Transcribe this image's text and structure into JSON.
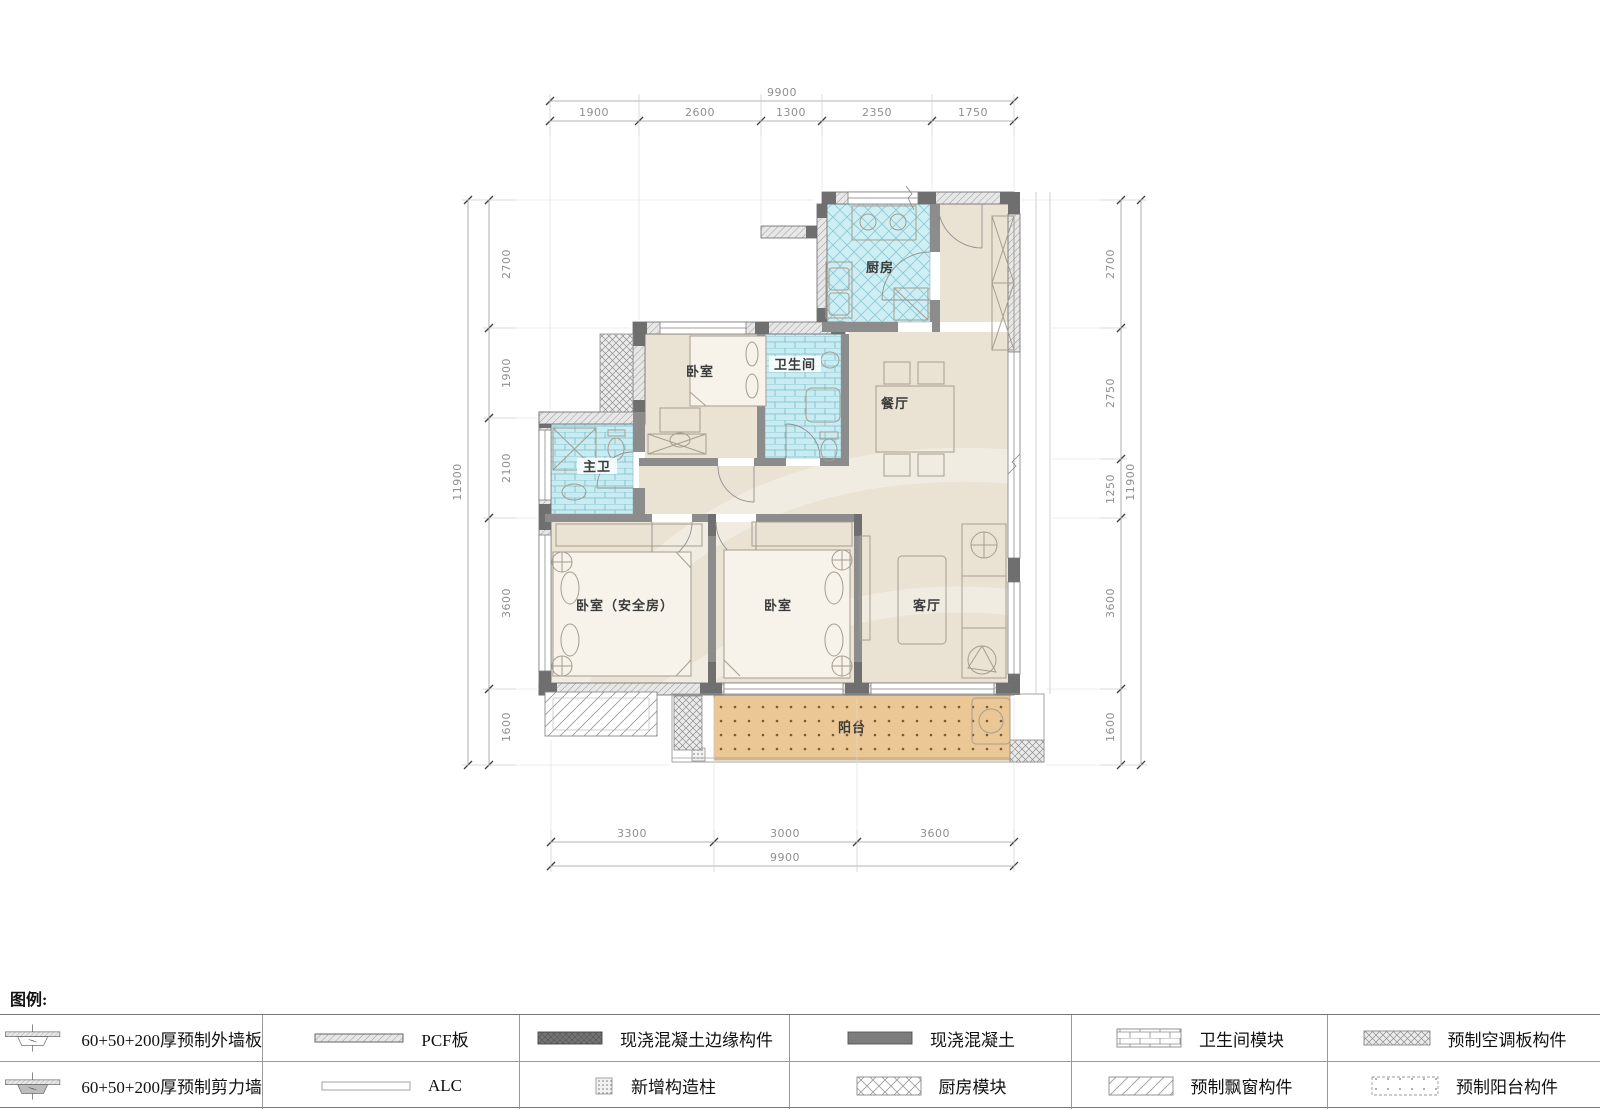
{
  "rooms": {
    "kitchen": "厨房",
    "bedroom_top": "卧室",
    "bathroom": "卫生间",
    "dining": "餐厅",
    "master_bath": "主卫",
    "bedroom_safe": "卧室（安全房）",
    "bedroom_mid": "卧室",
    "living": "客厅",
    "balcony": "阳台"
  },
  "dimensions": {
    "top": {
      "total": "9900",
      "segments": [
        "1900",
        "2600",
        "1300",
        "2350",
        "1750"
      ]
    },
    "bottom": {
      "total": "9900",
      "segments": [
        "3300",
        "3000",
        "3600"
      ]
    },
    "left": {
      "total": "11900",
      "segments": [
        "2700",
        "1900",
        "2100",
        "3600",
        "1600"
      ]
    },
    "right": {
      "total": "11900",
      "segments": [
        "2700",
        "2750",
        "1250",
        "3600",
        "1600"
      ]
    }
  },
  "legend": {
    "title": "图例:",
    "items": [
      {
        "id": "exterior-wall-panel",
        "label": "60+50+200厚预制外墙板"
      },
      {
        "id": "pcf-panel",
        "label": "PCF板"
      },
      {
        "id": "cip-edge-member",
        "label": "现浇混凝土边缘构件"
      },
      {
        "id": "cip-concrete",
        "label": "现浇混凝土"
      },
      {
        "id": "bathroom-module",
        "label": "卫生间模块"
      },
      {
        "id": "ac-slab-member",
        "label": "预制空调板构件"
      },
      {
        "id": "shear-wall",
        "label": "60+50+200厚预制剪力墙"
      },
      {
        "id": "alc",
        "label": "ALC"
      },
      {
        "id": "new-column",
        "label": "新增构造柱"
      },
      {
        "id": "kitchen-module",
        "label": "厨房模块"
      },
      {
        "id": "bay-window-member",
        "label": "预制飘窗构件"
      },
      {
        "id": "balcony-member",
        "label": "预制阳台构件"
      }
    ]
  },
  "colors": {
    "module_fill": "#cdeef3",
    "balcony_fill": "#ebc795",
    "floor_fill": "#eae3d4",
    "wall_dark": "#6f6f6f"
  }
}
